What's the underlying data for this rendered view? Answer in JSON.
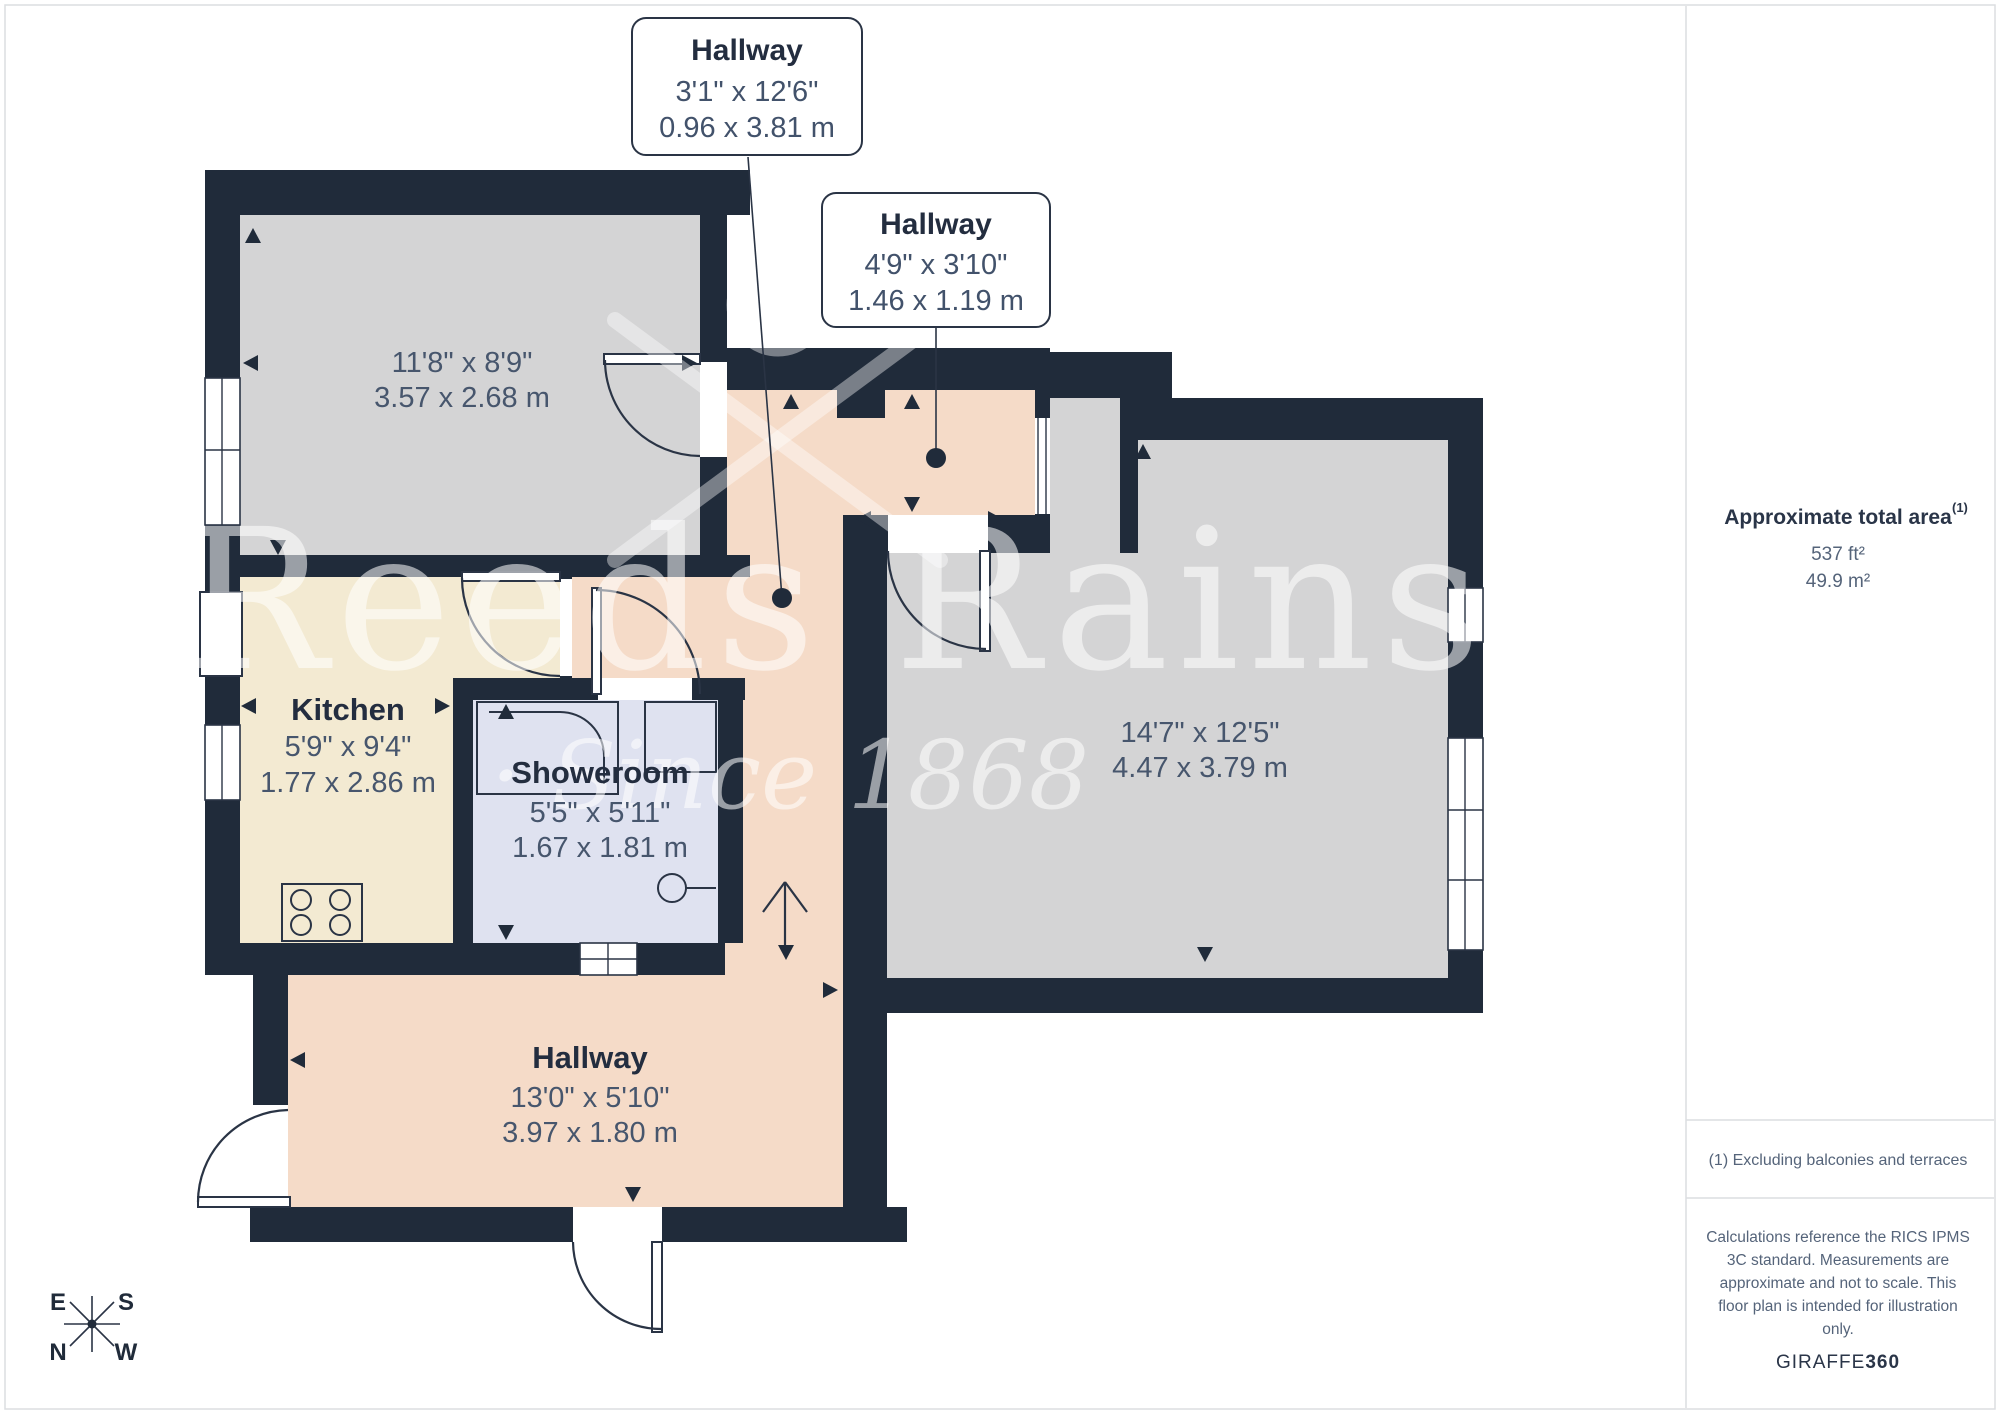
{
  "callouts": [
    {
      "room": "Hallway",
      "imperial": "3'1\" x 12'6\"",
      "metric": "0.96 x 3.81 m"
    },
    {
      "room": "Hallway",
      "imperial": "4'9\" x 3'10\"",
      "metric": "1.46 x 1.19 m"
    }
  ],
  "rooms": {
    "bedroom": {
      "imperial": "11'8\" x 8'9\"",
      "metric": "3.57 x 2.68 m"
    },
    "kitchen": {
      "name": "Kitchen",
      "imperial": "5'9\" x 9'4\"",
      "metric": "1.77 x 2.86 m"
    },
    "showeroom": {
      "name": "Showeroom",
      "imperial": "5'5\" x 5'11\"",
      "metric": "1.67 x 1.81 m"
    },
    "living": {
      "imperial": "14'7\" x 12'5\"",
      "metric": "4.47 x 3.79 m"
    },
    "hallway": {
      "name": "Hallway",
      "imperial": "13'0\" x 5'10\"",
      "metric": "3.97 x 1.80 m"
    }
  },
  "compass": {
    "n": "N",
    "e": "E",
    "s": "S",
    "w": "W"
  },
  "watermark": {
    "line1": "Reeds Rains",
    "line2": "· Since 1868"
  },
  "sidebar": {
    "title": "Approximate total area",
    "title_sup": "(1)",
    "area_imperial": "537 ft²",
    "area_metric": "49.9 m²",
    "note": "(1) Excluding balconies and terraces",
    "disclaimer": [
      "Calculations reference the RICS IPMS",
      "3C standard. Measurements are",
      "approximate and not to scale. This",
      "floor plan is intended for illustration",
      "only."
    ],
    "brand": "GIRAFFE",
    "brand_suffix": "360"
  },
  "colors": {
    "wall": "#202b3a",
    "hallway_fill": "#f5dbc8",
    "kitchen_fill": "#f3ead2",
    "room_gray_fill": "#d4d4d5",
    "showeroom_fill": "#dfe2f0",
    "label_text": "#232d3f",
    "dim_text": "#47566d"
  }
}
